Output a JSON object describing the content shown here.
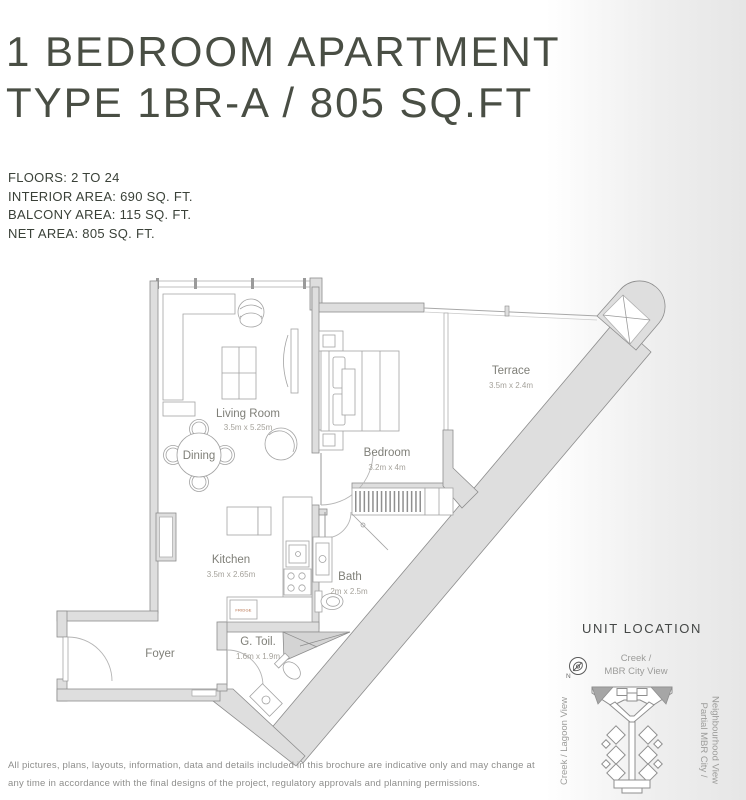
{
  "page": {
    "title_line1": "1 BEDROOM APARTMENT",
    "title_line2": "TYPE 1BR-A / 805 SQ.FT",
    "specs": [
      "FLOORS: 2 TO 24",
      "INTERIOR AREA: 690 SQ. FT.",
      "BALCONY AREA: 115 SQ. FT.",
      "NET AREA: 805 SQ. FT."
    ],
    "disclaimer_line1": "All pictures, plans, layouts, information, data and details included in this brochure are indicative only and may change at",
    "disclaimer_line2": "any time in accordance with the final designs of the project, regulatory approvals and planning permissions."
  },
  "floor_plan": {
    "rooms": [
      {
        "name": "Living Room",
        "dims": "3.5m x 5.25m"
      },
      {
        "name": "Dining",
        "dims": ""
      },
      {
        "name": "Bedroom",
        "dims": "3.2m x 4m"
      },
      {
        "name": "Terrace",
        "dims": "3.5m x 2.4m"
      },
      {
        "name": "Kitchen",
        "dims": "3.5m x 2.65m"
      },
      {
        "name": "Bath",
        "dims": "2m x 2.5m"
      },
      {
        "name": "G. Toil.",
        "dims": "1.6m x 1.9m"
      },
      {
        "name": "Foyer",
        "dims": ""
      }
    ],
    "fridge_label": "FRIDGE"
  },
  "unit_location": {
    "heading": "UNIT LOCATION",
    "compass_label": "N",
    "view_top_line1": "Creek /",
    "view_top_line2": "MBR City View",
    "view_left": "Creek / Lagoon View",
    "view_right_line1": "Partial MBR City /",
    "view_right_line2": "Neighbourhood View"
  },
  "colors": {
    "title_text": "#494e44",
    "spec_text": "#3a4138",
    "room_label": "#7f7f78",
    "dim_label": "#a5a29b",
    "fridge_accent": "#b2653c",
    "wall_fill": "#dedede",
    "unit_highlight": "#a6a6a6",
    "edge_shade": "#e6e6e6"
  }
}
